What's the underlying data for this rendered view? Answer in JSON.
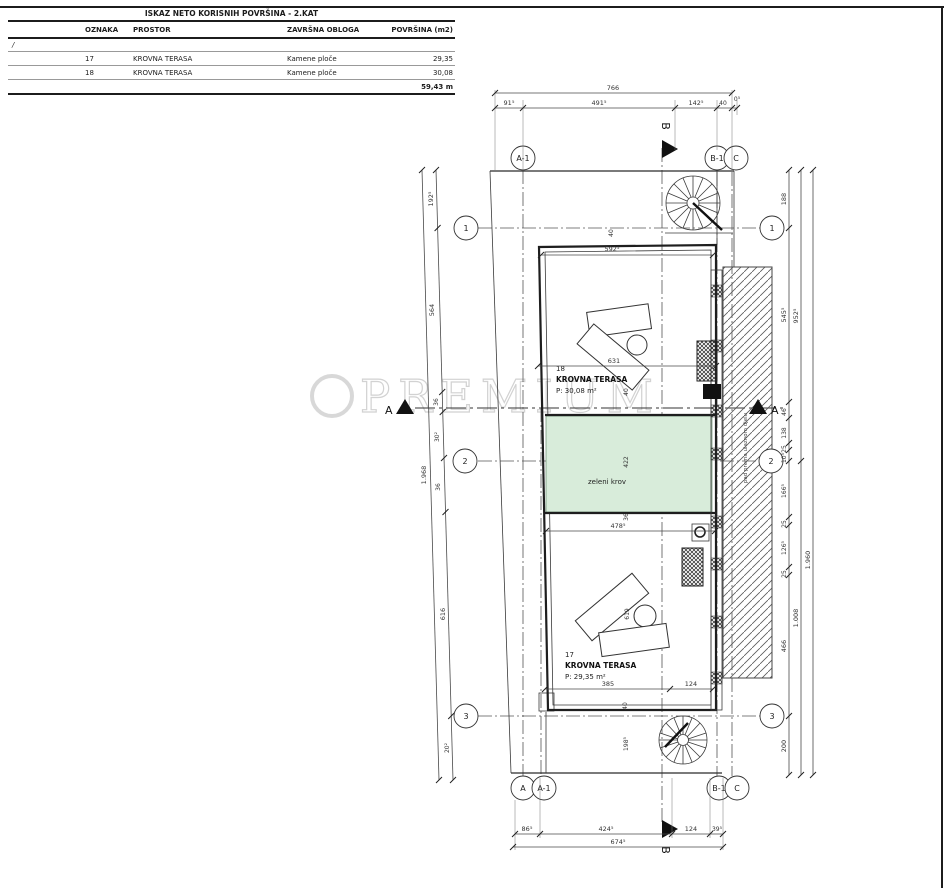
{
  "table": {
    "title": "ISKAZ NETO KORISNIH POVRŠINA - 2.KAT",
    "headers": [
      "OZNAKA",
      "PROSTOR",
      "ZAVRŠNA OBLOGA",
      "POVRŠINA (m2)"
    ],
    "slash": "/",
    "rows": [
      {
        "oznaka": "17",
        "prostor": "KROVNA TERASA",
        "obloga": "Kamene ploče",
        "povrsina": "29,35"
      },
      {
        "oznaka": "18",
        "prostor": "KROVNA TERASA",
        "obloga": "Kamene ploče",
        "povrsina": "30,08"
      }
    ],
    "total": "59,43 m"
  },
  "watermark": "PREMIUM",
  "grid": {
    "top": [
      "A-1",
      "B-1",
      "C"
    ],
    "bottom": [
      "A",
      "A-1",
      "B-1",
      "C"
    ],
    "left": [
      "1",
      "2",
      "3"
    ],
    "right": [
      "1",
      "2",
      "3"
    ]
  },
  "sections": {
    "a": "A",
    "b": "B"
  },
  "rooms": {
    "t18": {
      "num": "18",
      "name": "KROVNA TERASA",
      "area": "P: 30,08 m²"
    },
    "t17": {
      "num": "17",
      "name": "KROVNA TERASA",
      "area": "P: 29,35 m²"
    },
    "green": "zeleni krov",
    "wall_note": "pad prema ulaznom djelu"
  },
  "dims": {
    "top_total": "766",
    "top": [
      "91⁵",
      "491⁵",
      "142⁵",
      "40",
      "0⁵"
    ],
    "bottom": [
      "86⁵",
      "424⁵",
      "124",
      "39⁵"
    ],
    "bottom_total": "674⁵",
    "left": [
      "192⁵",
      "564",
      "36",
      "30²",
      "36",
      "616",
      "20²"
    ],
    "left_total": "1.968",
    "right": [
      "188",
      "545⁵",
      "46",
      "138",
      "25",
      "10⁵",
      "166⁵",
      "25",
      "126⁵",
      "25",
      "466",
      "200"
    ],
    "right_mid": [
      "952⁵",
      "1.008"
    ],
    "right_total": "1.960",
    "inner": {
      "a": "40",
      "b": "592⁵",
      "c": "631",
      "d": "40",
      "e": "422",
      "f": "36",
      "g": "478⁵",
      "h": "619",
      "i": "385",
      "j": "124",
      "k": "40",
      "l": "198⁵"
    }
  },
  "colors": {
    "green_roof": "#d8ecda"
  }
}
